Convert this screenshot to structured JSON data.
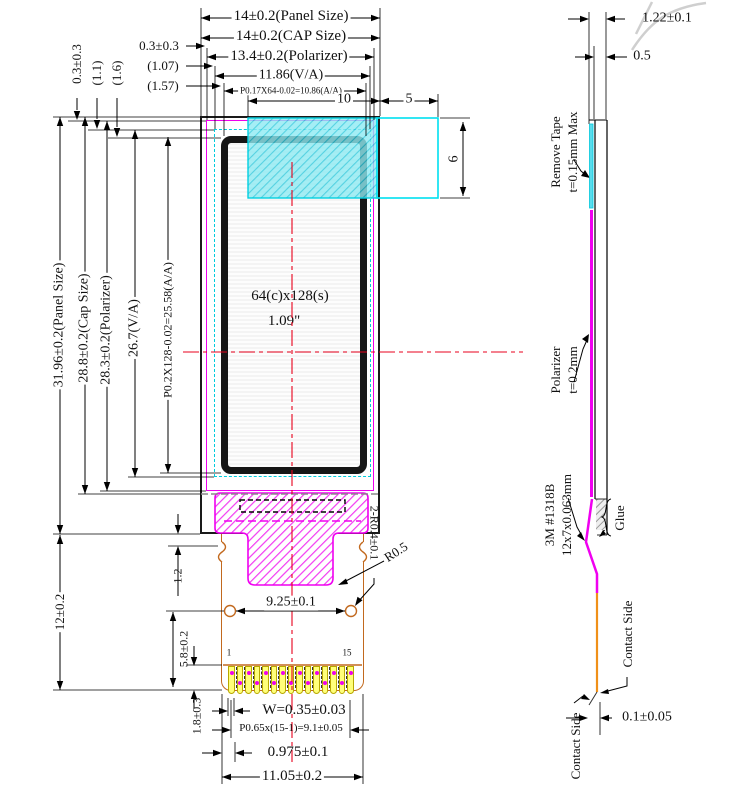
{
  "title": "OLED module mechanical drawing",
  "front_view": {
    "top_dims": {
      "panel": "14±0.2(Panel Size)",
      "cap": "14±0.2(CAP Size)",
      "polarizer": "13.4±0.2(Polarizer)",
      "va": "11.86(V/A)",
      "aa": "P0.17X64-0.02=10.86(A/A)",
      "tape_width": "10",
      "tape_overhang": "5"
    },
    "top_left_offsets": {
      "h_polarizer": "0.3±0.3",
      "h_va": "(1.07)",
      "h_aa": "(1.57)",
      "v_polarizer": "0.3±0.3",
      "v_va": "(1.1)",
      "v_aa": "(1.6)"
    },
    "left_dims": {
      "panel": "31.96±0.2(Panel Size)",
      "cap": "28.8±0.2(Cap Size)",
      "polarizer": "28.3±0.2(Polarizer)",
      "va": "26.7(V/A)",
      "aa": "P0.2X128-0.02=25.58(A/A)",
      "fpc_length": "12±0.2",
      "ledge": "1.2",
      "hole_offset": "5.8±0.2",
      "pad_height": "1.8±0.3"
    },
    "center": {
      "resolution": "64(c)x128(s)",
      "diagonal": "1.09\""
    },
    "tape_height": "6",
    "mid": {
      "hole_radius": "2-R0.4±0.1",
      "corner_radius": "R0.5",
      "hole_pitch": "9.25±0.1"
    },
    "pins": {
      "first": "1",
      "last": "15",
      "count": 15
    },
    "bottom_dims": {
      "pad_width": "W=0.35±0.03",
      "pitch": "P0.65x(15-1)=9.1±0.05",
      "edge_offset": "0.975±0.1",
      "fpc_width": "11.05±0.2"
    }
  },
  "side_view": {
    "dims": {
      "total_thickness": "1.22±0.1",
      "glass_thickness": "0.5",
      "fpc_offset": "0.1±0.05"
    },
    "labels": {
      "tape_line1": "Remove Tape",
      "tape_line2": "t=0.15mm Max",
      "polarizer_line1": "Polarizer",
      "polarizer_line2": "t=0.2mm",
      "adhesive_line1": "3M #1318B",
      "adhesive_line2": "12x7x0.063mm",
      "glue": "Glue",
      "contact_side_right": "Contact Side",
      "contact_side_bottom": "Contact Side"
    }
  },
  "colors": {
    "polarizer_outline": "#ee00ee",
    "va_outline": "#00ccdd",
    "tape_fill": "#86e9f2",
    "fpc_outline": "#c2691e",
    "pad_fill": "#ffff7a",
    "centerline_red": "#e8001c",
    "orange_fpc": "#f09018"
  }
}
